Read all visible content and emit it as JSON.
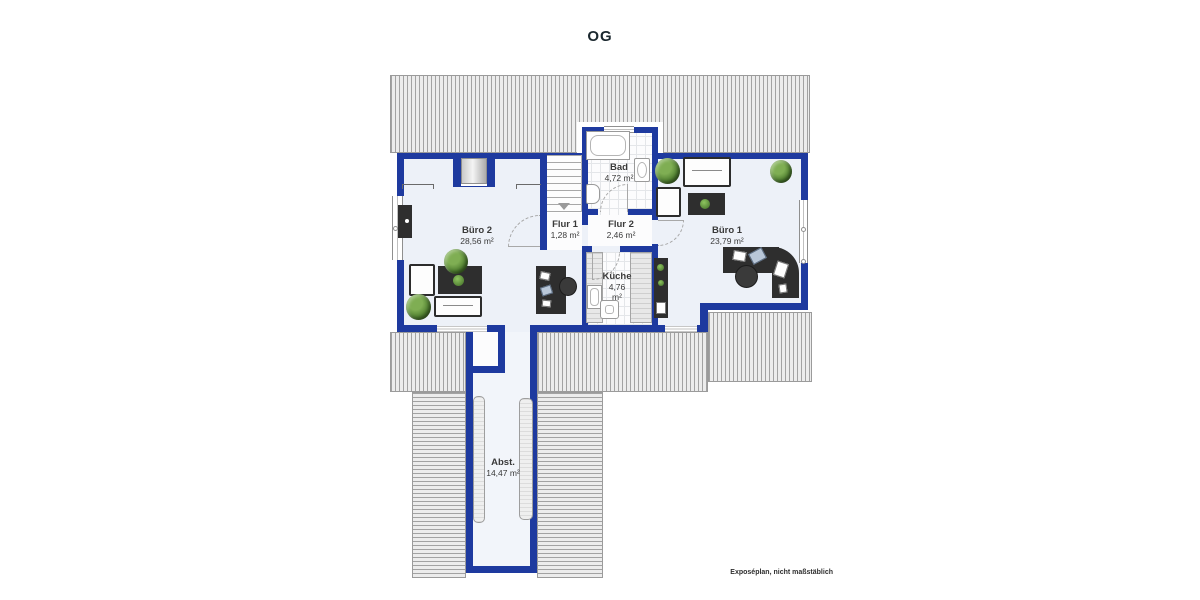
{
  "title": "OG",
  "footer": {
    "note": "Exposéplan, nicht maßstäblich"
  },
  "rooms": {
    "buero2": {
      "name": "Büro 2",
      "area": "28,56 m²"
    },
    "flur1": {
      "name": "Flur 1",
      "area": "1,28 m²"
    },
    "bad": {
      "name": "Bad",
      "area": "4,72 m²"
    },
    "flur2": {
      "name": "Flur 2",
      "area": "2,46 m²"
    },
    "kueche": {
      "name": "Küche",
      "area_value": "4,76",
      "area_unit": "m²"
    },
    "buero1": {
      "name": "Büro 1",
      "area": "23,79 m²"
    },
    "abst": {
      "name": "Abst.",
      "area": "14,47 m²"
    }
  },
  "colors": {
    "wall": "#1e3a9f",
    "floor": "#edf1f8",
    "roof_hatch_bg": "#ececec",
    "roof_hatch_line": "#a2a2a2",
    "furniture_dark": "#2e2e2e",
    "plant_green": "#4e7d2f"
  }
}
